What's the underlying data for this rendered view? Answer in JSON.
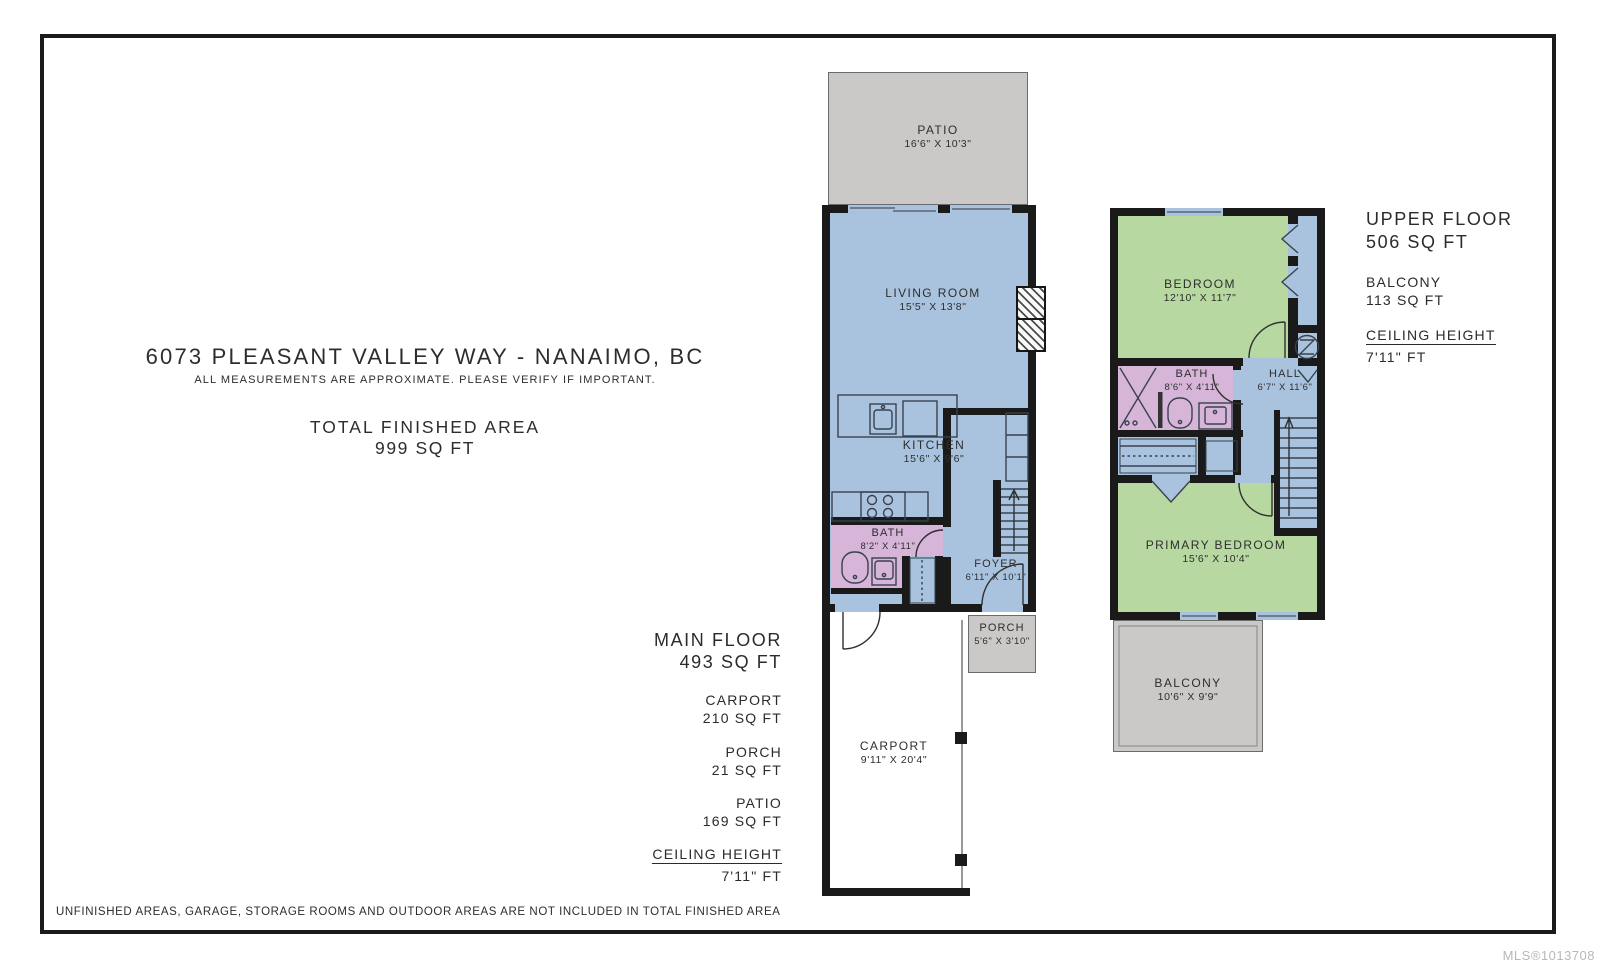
{
  "header": {
    "address": "6073 PLEASANT VALLEY WAY - NANAIMO, BC",
    "measurements_note": "ALL MEASUREMENTS ARE APPROXIMATE. PLEASE VERIFY IF IMPORTANT.",
    "total_area_label": "TOTAL FINISHED AREA",
    "total_area_value": "999 SQ FT"
  },
  "main_floor": {
    "summary": {
      "floor_label": "MAIN FLOOR",
      "floor_area": "493 SQ FT",
      "items": [
        {
          "label": "CARPORT",
          "value": "210 SQ FT"
        },
        {
          "label": "PORCH",
          "value": "21 SQ FT"
        },
        {
          "label": "PATIO",
          "value": "169 SQ FT"
        }
      ],
      "ceiling_label": "CEILING HEIGHT",
      "ceiling_value": "7'11\" FT"
    },
    "rooms": {
      "patio": {
        "name": "PATIO",
        "dims": "16'6\" X 10'3\""
      },
      "living_room": {
        "name": "LIVING ROOM",
        "dims": "15'5\" X 13'8\""
      },
      "kitchen": {
        "name": "KITCHEN",
        "dims": "15'6\" X 9'6\""
      },
      "bath": {
        "name": "BATH",
        "dims": "8'2\" X 4'11\""
      },
      "foyer": {
        "name": "FOYER",
        "dims": "6'11\" X 10'1\""
      },
      "porch": {
        "name": "PORCH",
        "dims": "5'6\" X 3'10\""
      },
      "carport": {
        "name": "CARPORT",
        "dims": "9'11\" X 20'4\""
      }
    }
  },
  "upper_floor": {
    "summary": {
      "floor_label": "UPPER FLOOR",
      "floor_area": "506 SQ FT",
      "items": [
        {
          "label": "BALCONY",
          "value": "113 SQ FT"
        }
      ],
      "ceiling_label": "CEILING HEIGHT",
      "ceiling_value": "7'11\" FT"
    },
    "rooms": {
      "bedroom": {
        "name": "BEDROOM",
        "dims": "12'10\" X 11'7\""
      },
      "bath": {
        "name": "BATH",
        "dims": "8'6\" X 4'11\""
      },
      "hall": {
        "name": "HALL",
        "dims": "6'7\" X 11'6\""
      },
      "primary_bedroom": {
        "name": "PRIMARY BEDROOM",
        "dims": "15'6\" X 10'4\""
      },
      "balcony": {
        "name": "BALCONY",
        "dims": "10'6\" X 9'9\""
      }
    }
  },
  "footer": {
    "note": "UNFINISHED AREAS, GARAGE, STORAGE ROOMS AND OUTDOOR AREAS ARE NOT INCLUDED IN TOTAL FINISHED AREA"
  },
  "watermark": "MLS®1013708",
  "colors": {
    "living_area": "#a9c3df",
    "bedroom": "#b7d8a1",
    "bathroom": "#d6b5d8",
    "outdoor": "#cac9c8",
    "wall": "#1a1a1a"
  }
}
